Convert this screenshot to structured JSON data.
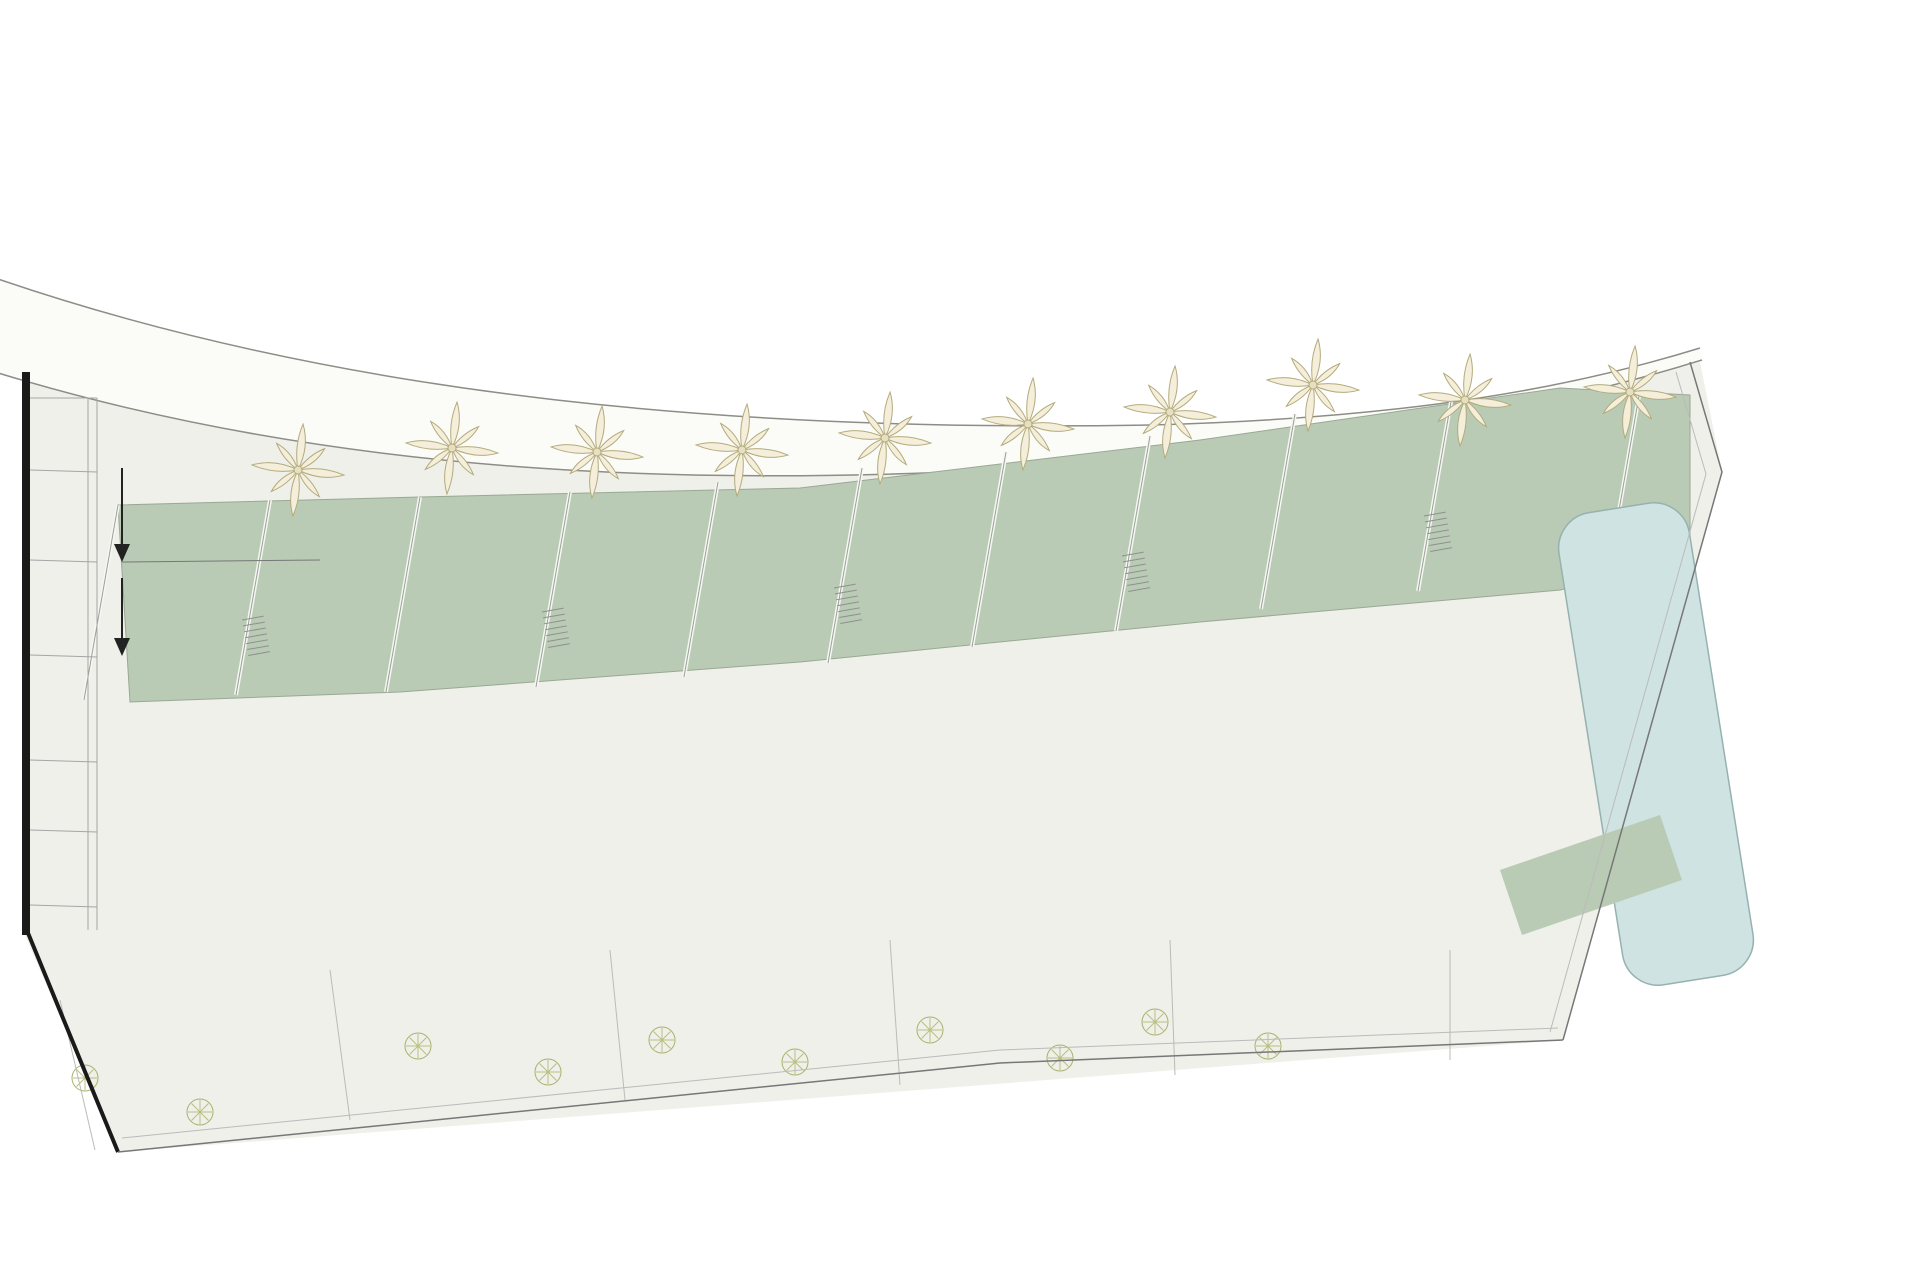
{
  "plan": {
    "title": "PLANTA BAJA / GROUND FLOOR",
    "watermark": "www.rayodelsol.com"
  },
  "labels": {
    "jardin": "JARDÍN",
    "abajo": "ABAJO"
  },
  "gardens": [
    "66,14",
    "63,27",
    "43,20",
    "56,77",
    "41,58",
    "54,97",
    "43,20",
    "56,78",
    "45,17",
    "64,41"
  ],
  "unit_pairs": [
    [
      "1",
      "2"
    ],
    [
      "3",
      "4"
    ],
    [
      "5",
      "6"
    ],
    [
      "7",
      "8"
    ],
    [
      "9",
      "10"
    ]
  ],
  "colors": {
    "garden_green": "#b9cbb4",
    "terrace_grey": "#d8dbd6",
    "building_tan": "#f2e0c3",
    "pool_blue": "#cfe3e2",
    "wall_black": "#1a1a1a",
    "site_ground": "#eef0e9",
    "road_white": "#fbfbf8"
  }
}
